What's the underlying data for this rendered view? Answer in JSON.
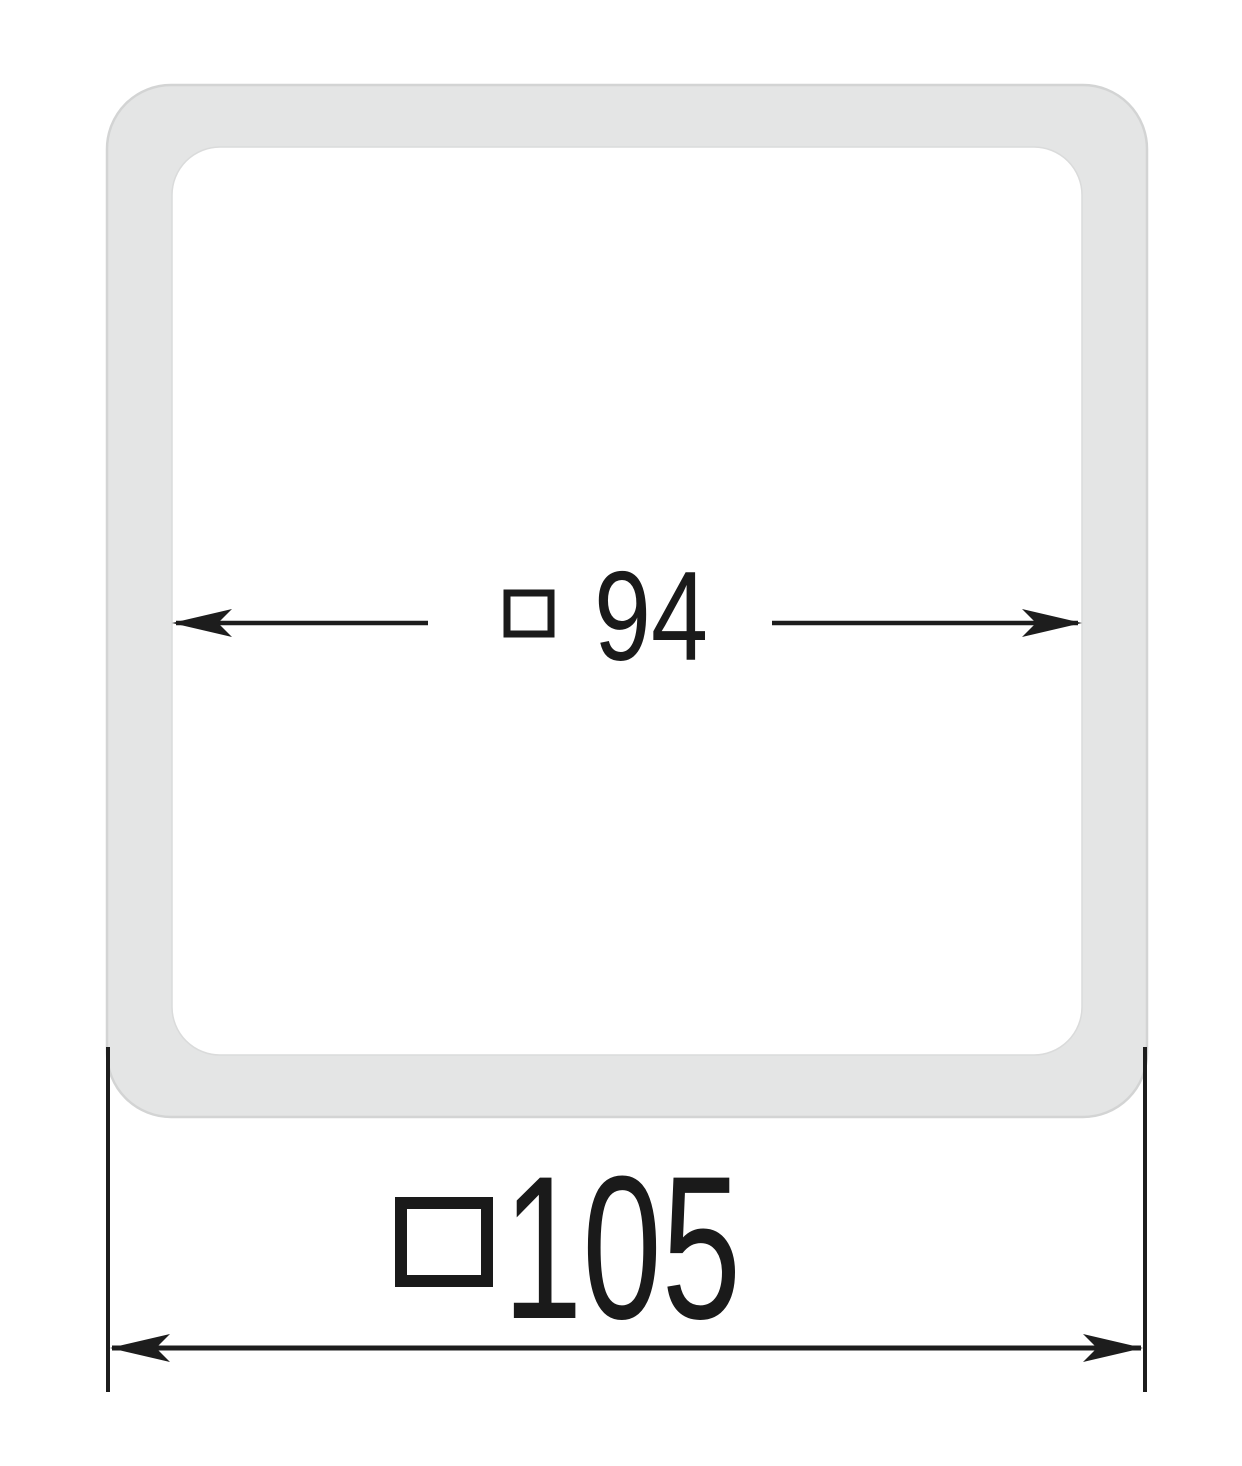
{
  "drawing": {
    "kind": "technical-dimension-drawing",
    "part": "square-frame-end-cap",
    "inner_dimension": {
      "symbol": "square",
      "value": "94",
      "label": "□ 94"
    },
    "outer_dimension": {
      "symbol": "square",
      "value": "105",
      "label": "□105"
    },
    "colors": {
      "background": "#ffffff",
      "frame_fill": "#e4e5e5",
      "frame_outline": "#d3d4d4",
      "inner_edge": "#dadbdb",
      "ink": "#1d1d1d"
    }
  }
}
